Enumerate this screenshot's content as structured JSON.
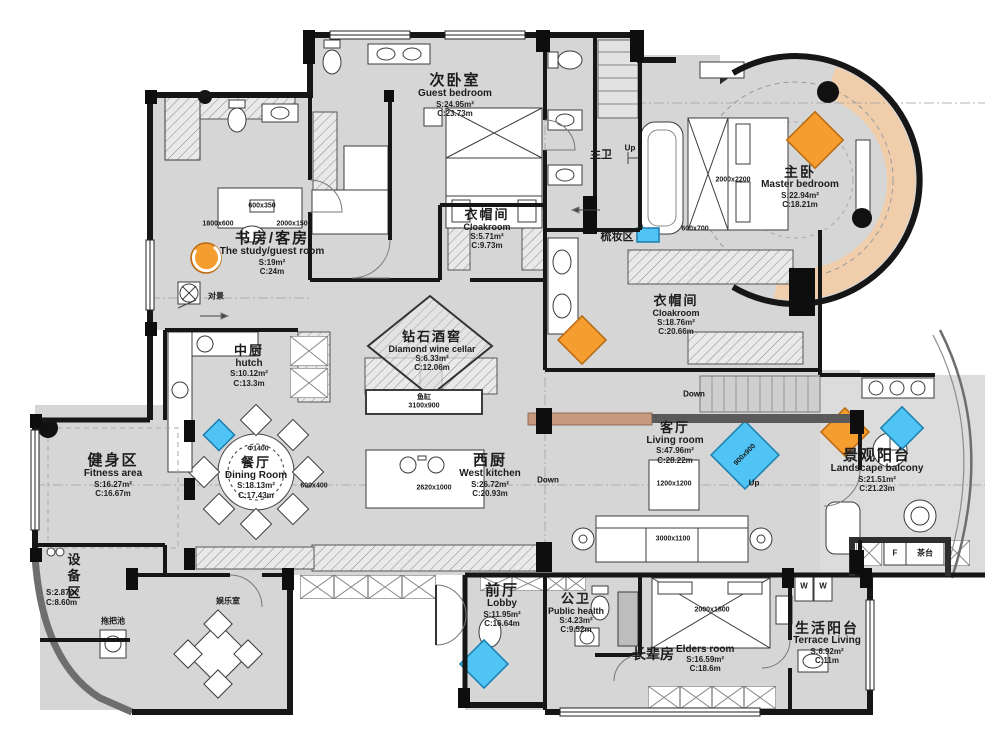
{
  "rooms": {
    "guest_bedroom": {
      "cn": "次卧室",
      "en": "Guest bedroom",
      "area": "S:24.95m²",
      "length": "C:23.73m"
    },
    "master_bedroom": {
      "cn": "主卧",
      "en": "Master bedroom",
      "area": "S:22.94m²",
      "length": "C:18.21m"
    },
    "study": {
      "cn": "书房/客房",
      "en": "The study/guest room",
      "area": "S:19m²",
      "length": "C:24m"
    },
    "cloakroom_small": {
      "cn": "衣帽间",
      "en": "Cloakroom",
      "area": "S:5.71m²",
      "length": "C:9.73m"
    },
    "cloakroom_master": {
      "cn": "衣帽间",
      "en": "Cloakroom",
      "area": "S:18.76m²",
      "length": "C:20.66m"
    },
    "hutch": {
      "cn": "中厨",
      "en": "hutch",
      "area": "S:10.12m²",
      "length": "C:13.3m"
    },
    "wine_cellar": {
      "cn": "钻石酒窖",
      "en": "Diamond wine cellar",
      "area": "S:6.33m²",
      "length": "C:12.06m"
    },
    "fitness": {
      "cn": "健身区",
      "en": "Fitness area",
      "area": "S:16.27m²",
      "length": "C:16.67m"
    },
    "dining": {
      "cn": "餐厅",
      "en": "Dining Room",
      "area": "S:18.13m²",
      "length": "C:17.43m"
    },
    "west_kitchen": {
      "cn": "西厨",
      "en": "West kitchen",
      "area": "S:26.72m²",
      "length": "C:20.93m"
    },
    "living": {
      "cn": "客厅",
      "en": "Living room",
      "area": "S:47.96m²",
      "length": "C:28.22m"
    },
    "balcony": {
      "cn": "景观阳台",
      "en": "Landscape balcony",
      "area": "S:21.51m²",
      "length": "C:21.23m"
    },
    "equipment": {
      "cn": "设备区",
      "area": "S:2.87m²",
      "length": "C:8.60m"
    },
    "lobby": {
      "cn": "前厅",
      "en": "Lobby",
      "area": "S:11.95m²",
      "length": "C:16.64m"
    },
    "public_bath": {
      "cn": "公卫",
      "en": "Public health",
      "area": "S:4.23m²",
      "length": "C:9.52m"
    },
    "elders": {
      "cn": "长辈房",
      "en": "Elders room",
      "area": "S:16.59m²",
      "length": "C:18.6m"
    },
    "terrace": {
      "cn": "生活阳台",
      "en": "Terrace Living",
      "area": "S:6.92m²",
      "length": "C:11m"
    }
  },
  "small_labels": {
    "master_bath": "主卫",
    "dressing": "梳妆区",
    "view": "对景",
    "entertainment": "娱乐室",
    "mop_pool": "拖把池",
    "tea_table": "茶台",
    "fridge": "F",
    "washer": "W",
    "fish_tank": "鱼缸"
  },
  "directions": {
    "up": "Up",
    "down": "Down"
  },
  "dims": {
    "study_desk_a": "1800x600",
    "study_desk_b": "2000x1500",
    "study_box": "600x350",
    "master_bed": "2000x2200",
    "master_side": "600x700",
    "fish_tank": "3100x900",
    "dining_table": "Φ1400",
    "dining_side": "600x400",
    "kitchen_island": "2620x1000",
    "living_rug": "1200x1200",
    "living_chair": "900x900",
    "sofa": "3000x1100",
    "elders_bed": "2000x1800"
  },
  "colors": {
    "floor": "#d6d6d6",
    "wall": "#161616",
    "accent_orange": "#f59e2f",
    "accent_blue": "#4fc4f5",
    "peach": "#f1cdaa",
    "salmon": "#c69a7e"
  }
}
